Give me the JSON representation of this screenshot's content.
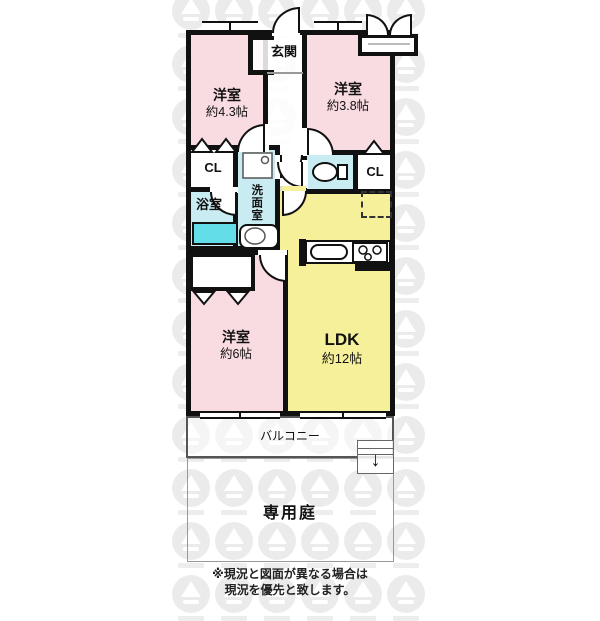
{
  "rooms": {
    "entrance": {
      "label": "玄関"
    },
    "bedroom43": {
      "label": "洋室",
      "size": "約4.3帖"
    },
    "bedroom38": {
      "label": "洋室",
      "size": "約3.8帖"
    },
    "bedroom6": {
      "label": "洋室",
      "size": "約6帖"
    },
    "ldk": {
      "label": "LDK",
      "size": "約12帖"
    },
    "closet_left": {
      "label": "CL"
    },
    "closet_right": {
      "label": "CL"
    },
    "bathroom": {
      "label": "浴室"
    },
    "washroom": {
      "label": "洗面室"
    },
    "balcony": {
      "label": "バルコニー"
    },
    "garden": {
      "label": "専用庭"
    }
  },
  "note": {
    "line1": "※現況と図面が異なる場合は",
    "line2": "現況を優先と致します。"
  },
  "icons": {
    "hatch_arrow": "↓"
  },
  "colors": {
    "bedroom": "#f9dce2",
    "ldk": "#f6f09a",
    "wet": "#c9ecf2",
    "bathtub": "#63dde8",
    "wall": "#111111",
    "wm": "#dcdcdc"
  }
}
